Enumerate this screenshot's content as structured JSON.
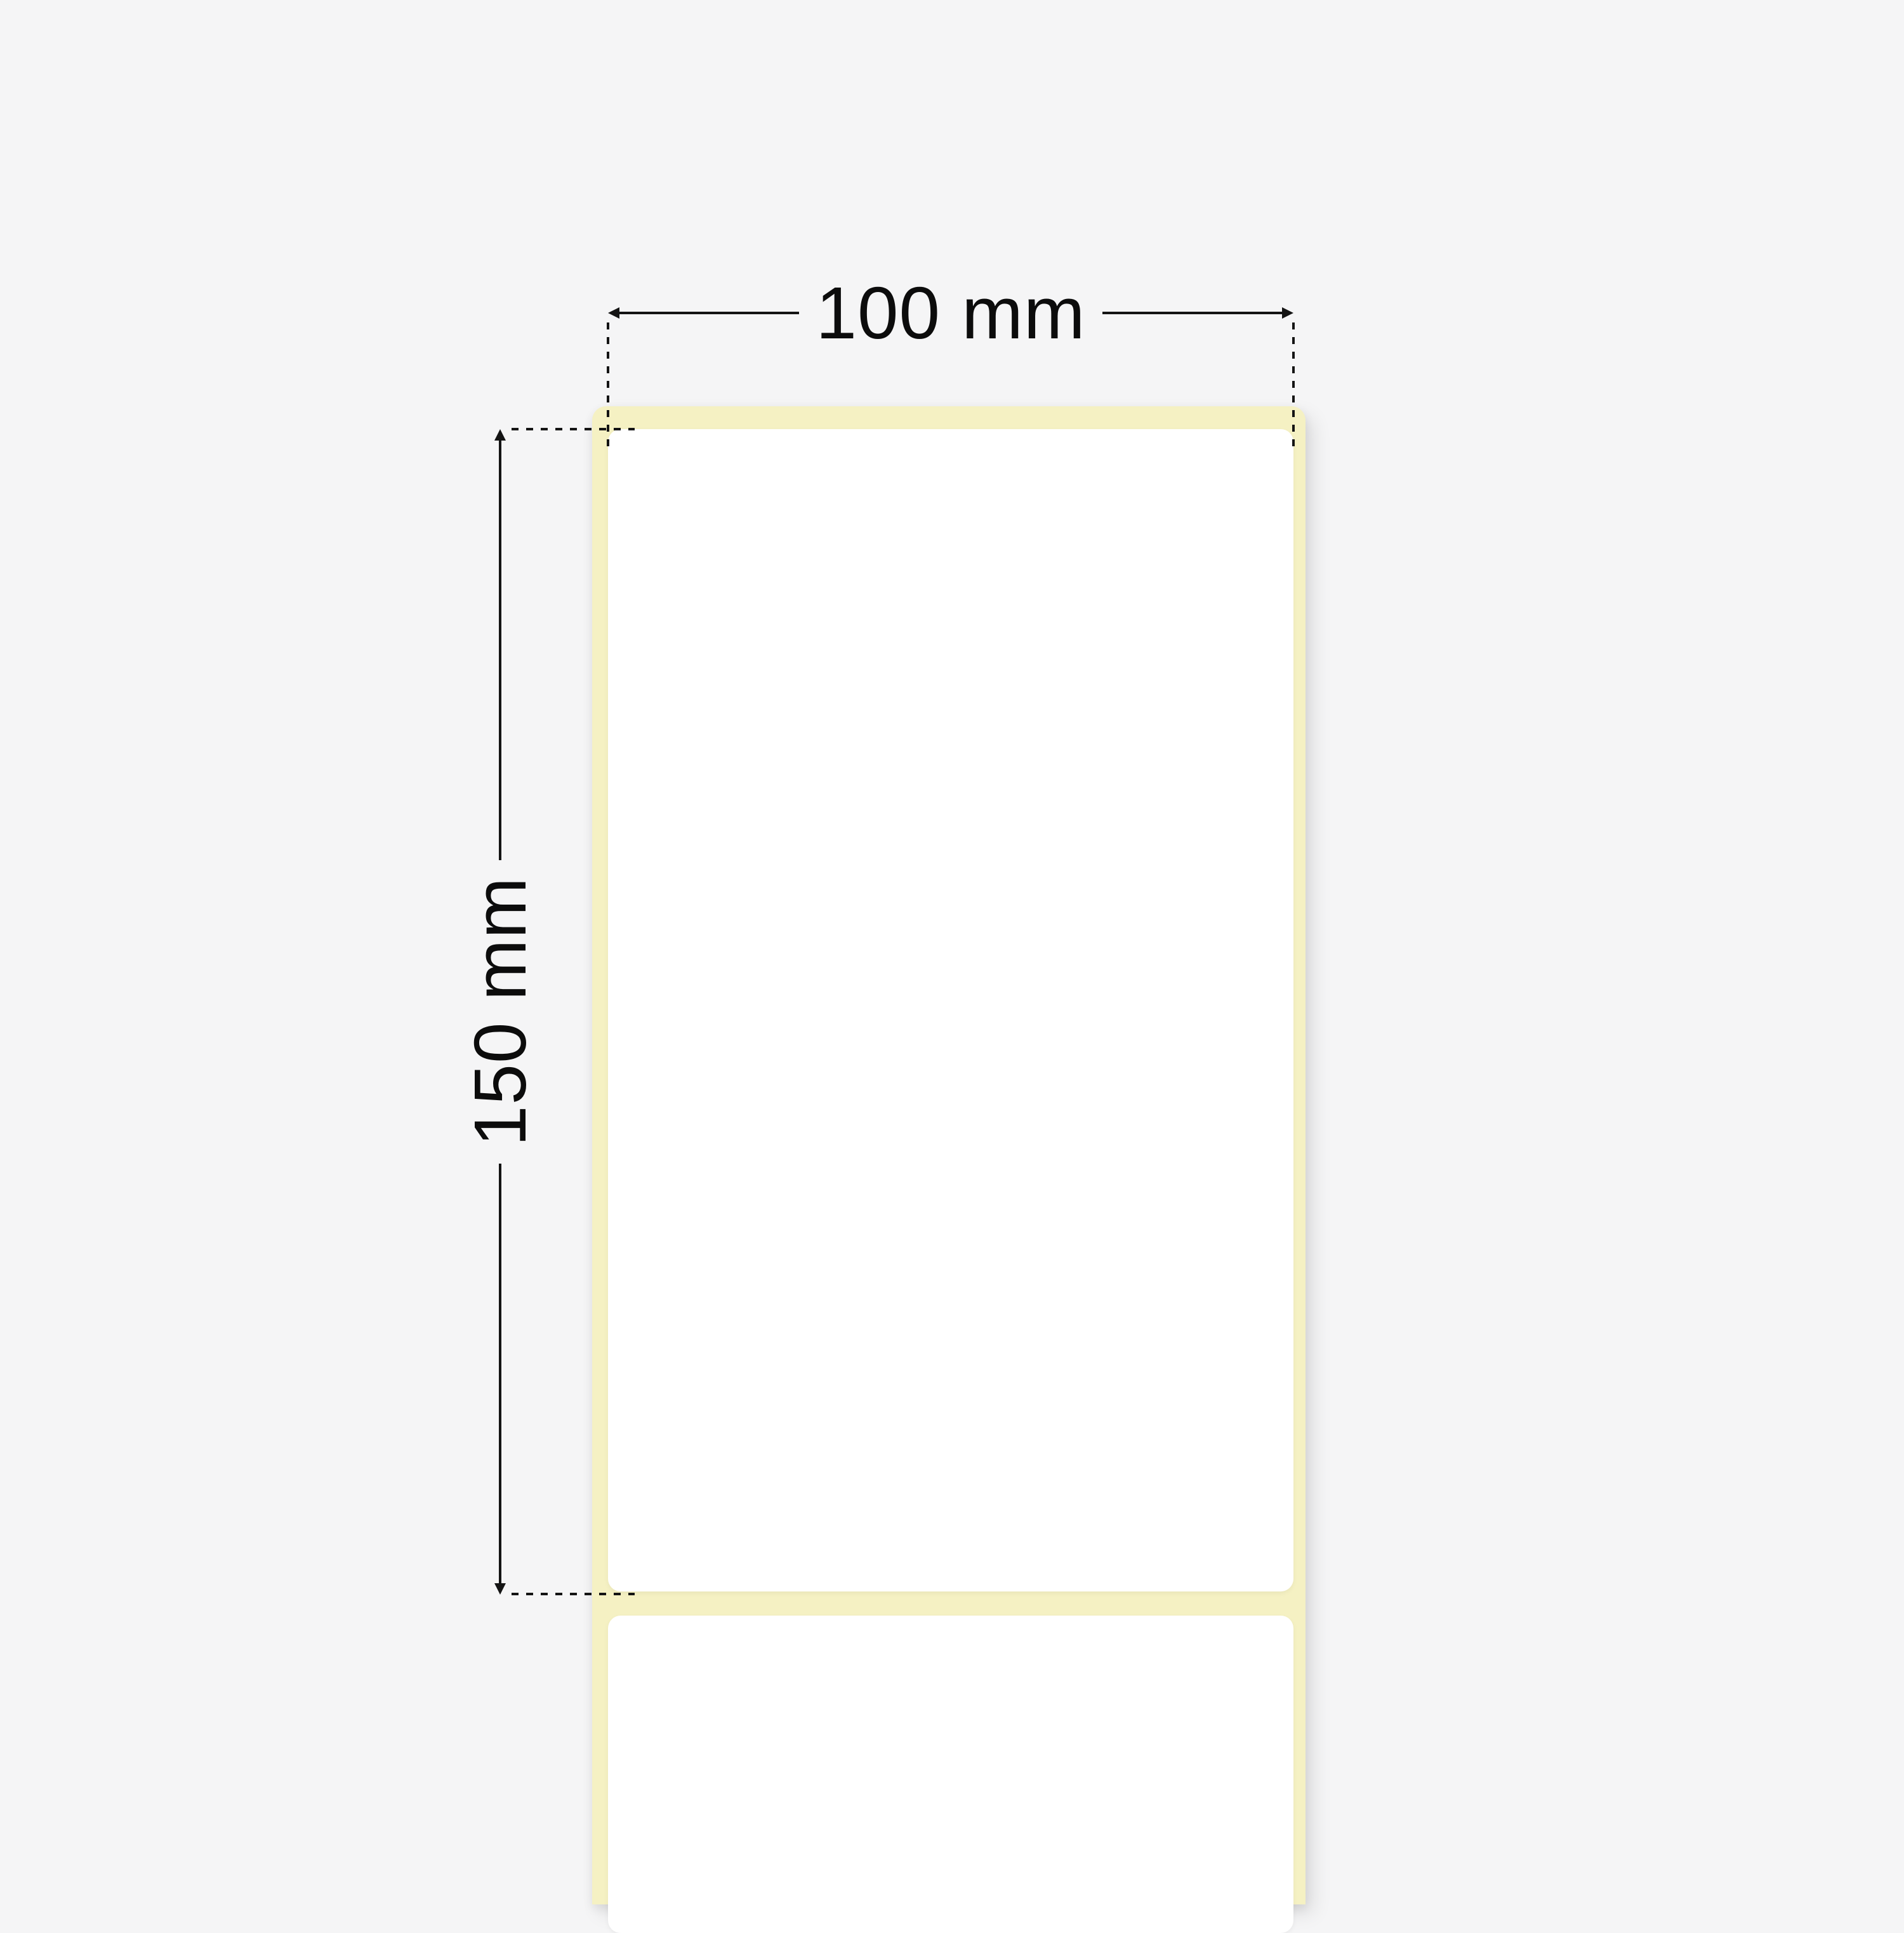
{
  "dimensions": {
    "width": {
      "label": "100 mm"
    },
    "height": {
      "label": "150 mm"
    }
  },
  "colors": {
    "background": "#f5f5f6",
    "liner": "#f5f1c3",
    "label_face": "#ffffff",
    "dimension_lines": "#141414"
  },
  "icons": {
    "arrow_left": "triangle-left",
    "arrow_right": "triangle-right",
    "arrow_up": "triangle-up",
    "arrow_down": "triangle-down"
  }
}
